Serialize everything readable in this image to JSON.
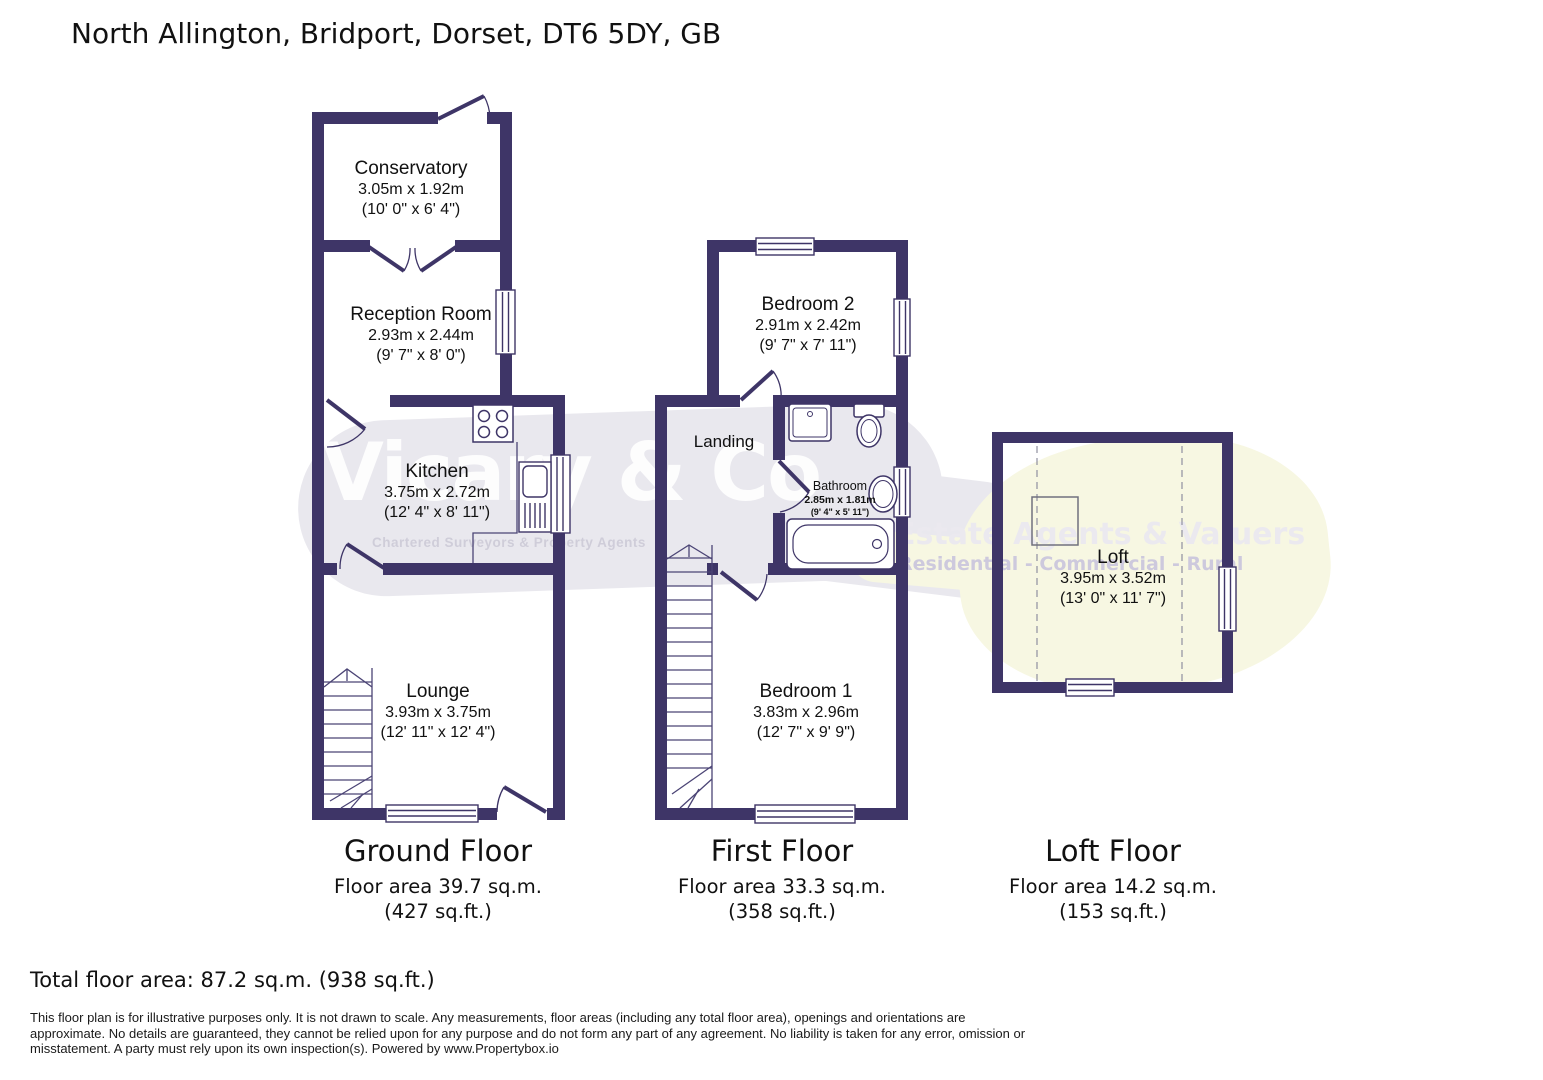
{
  "title": "North Allington, Bridport, Dorset, DT6 5DY, GB",
  "watermark": {
    "brand": "Vicary & Co",
    "tagline": "Chartered Surveyors & Property Agents",
    "estate_line": "Estate Agents & Valuers",
    "sectors_line": "Residential - Commercial - Rural"
  },
  "floor_plans": {
    "ground": {
      "caption": "Ground Floor",
      "area": "Floor area 39.7 sq.m. (427 sq.ft.)",
      "rooms": {
        "conservatory": {
          "name": "Conservatory",
          "metric": "3.05m x 1.92m",
          "imperial": "(10' 0\" x 6' 4\")"
        },
        "reception": {
          "name": "Reception Room",
          "metric": "2.93m x 2.44m",
          "imperial": "(9' 7\" x 8' 0\")"
        },
        "kitchen": {
          "name": "Kitchen",
          "metric": "3.75m x 2.72m",
          "imperial": "(12' 4\" x 8' 11\")"
        },
        "lounge": {
          "name": "Lounge",
          "metric": "3.93m x 3.75m",
          "imperial": "(12' 11\" x 12' 4\")"
        }
      }
    },
    "first": {
      "caption": "First Floor",
      "area": "Floor area 33.3 sq.m. (358 sq.ft.)",
      "rooms": {
        "bedroom2": {
          "name": "Bedroom 2",
          "metric": "2.91m x 2.42m",
          "imperial": "(9' 7\" x 7' 11\")"
        },
        "landing": {
          "name": "Landing"
        },
        "bathroom": {
          "name": "Bathroom",
          "metric": "2.85m x 1.81m",
          "imperial": "(9' 4\" x 5' 11\")"
        },
        "bedroom1": {
          "name": "Bedroom 1",
          "metric": "3.83m x 2.96m",
          "imperial": "(12' 7\" x 9' 9\")"
        }
      }
    },
    "loft": {
      "caption": "Loft Floor",
      "area": "Floor area 14.2 sq.m. (153 sq.ft.)",
      "rooms": {
        "loft": {
          "name": "Loft",
          "metric": "3.95m x 3.52m",
          "imperial": "(13' 0\" x 11' 7\")"
        }
      }
    }
  },
  "total": "Total floor area: 87.2 sq.m. (938 sq.ft.)",
  "disclaimer": [
    "This floor plan is for illustrative purposes only. It is not drawn to scale. Any measurements, floor areas (including any total floor area), openings and orientations are",
    "approximate. No details are guaranteed, they cannot be relied upon for any purpose and do not form any part of any agreement. No liability is taken for any error, omission or",
    "misstatement. A party must rely upon its own inspection(s). Powered by www.Propertybox.io"
  ],
  "colors": {
    "wall": "#3e3567",
    "watermark_gray": "#e9e8ee",
    "watermark_yellow": "#f7f7e2"
  }
}
